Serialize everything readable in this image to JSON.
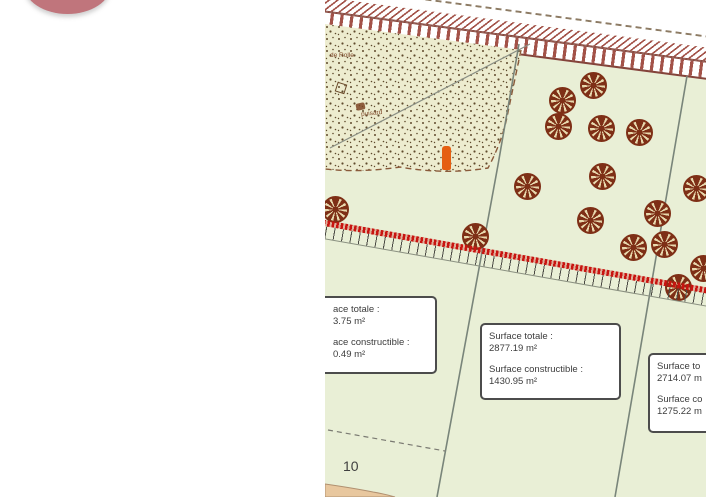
{
  "colors": {
    "rose": "#c0757c",
    "map_bg": "#e9efd6",
    "stipple_bg": "#edeccf",
    "stipple_dot": "#5f4a2c",
    "tree": "#7e2f16",
    "tree_gap": "#e8d9ae",
    "talus_red": "#c81410",
    "tick": "#4a4a44",
    "rail": "#a35248",
    "rail_dark": "#84443a",
    "road_dash": "#8d7b64",
    "line_gray": "#79857a",
    "dashed_brown": "#8a5a3a",
    "box_border": "#4c4c4c",
    "text": "#3c3c3c",
    "orange": "#e55f12",
    "tan": "#e8c79e"
  },
  "map": {
    "parcel_number": "10",
    "stipple_label_1": "de Rolle",
    "stipple_label_2": "puisard",
    "boxes": [
      {
        "line1": "ace totale :",
        "value1": "3.75 m²",
        "line2": "ace constructible :",
        "value2": "0.49 m²"
      },
      {
        "line1": "Surface totale :",
        "value1": "2877.19 m²",
        "line2": "Surface constructible :",
        "value2": "1430.95 m²"
      },
      {
        "line1": "Surface to",
        "value1": "2714.07 m",
        "line2": "Surface co",
        "value2": "1275.22 m"
      }
    ],
    "trees": [
      {
        "x": 237,
        "y": 100
      },
      {
        "x": 268,
        "y": 85
      },
      {
        "x": 233,
        "y": 126
      },
      {
        "x": 276,
        "y": 128
      },
      {
        "x": 314,
        "y": 132
      },
      {
        "x": 202,
        "y": 186
      },
      {
        "x": 277,
        "y": 176
      },
      {
        "x": 371,
        "y": 188
      },
      {
        "x": 265,
        "y": 220
      },
      {
        "x": 332,
        "y": 213
      },
      {
        "x": 339,
        "y": 244
      },
      {
        "x": 308,
        "y": 247
      },
      {
        "x": 150,
        "y": 236
      },
      {
        "x": 10,
        "y": 209
      },
      {
        "x": 353,
        "y": 287
      },
      {
        "x": 378,
        "y": 268
      }
    ]
  }
}
